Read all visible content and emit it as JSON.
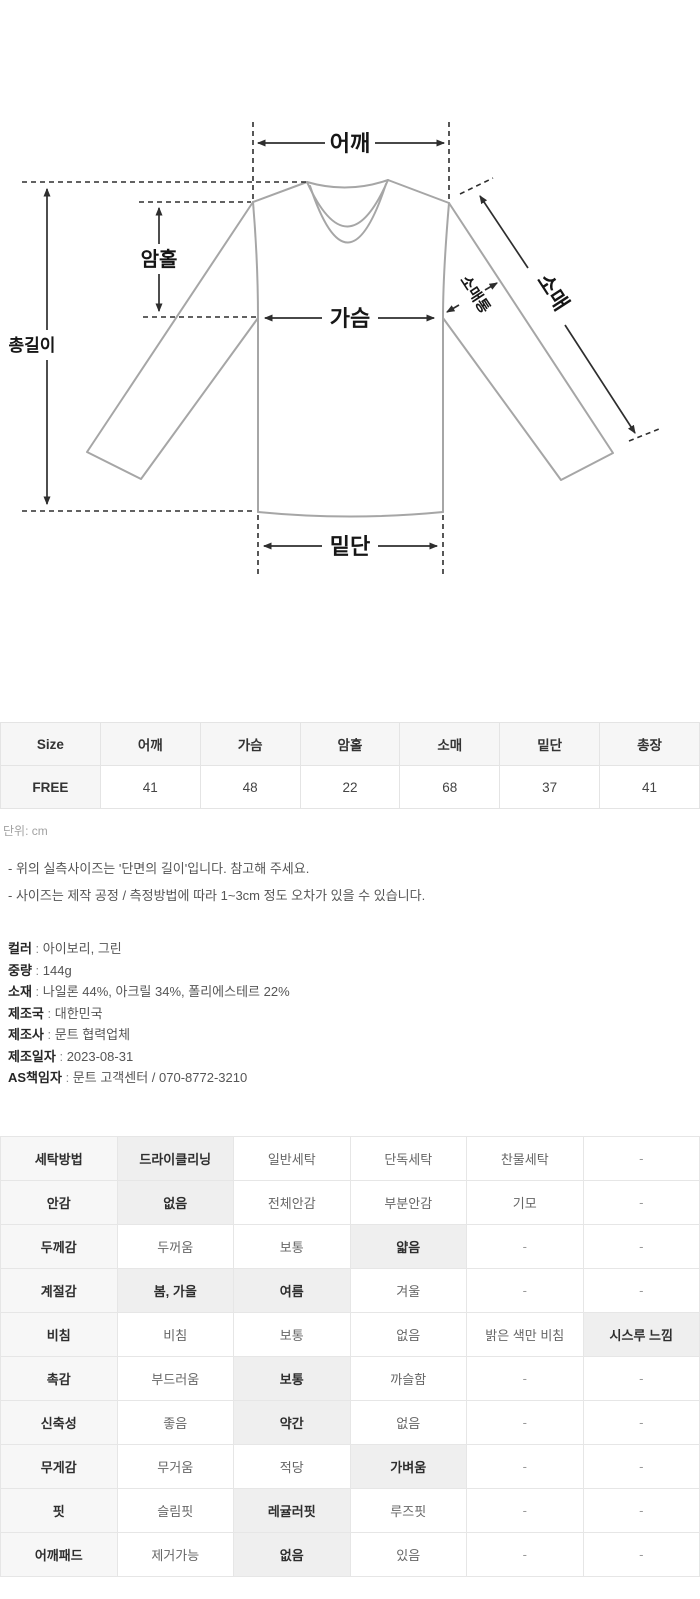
{
  "diagram": {
    "labels": {
      "shoulder": "어깨",
      "armhole": "암홀",
      "chest": "가슴",
      "sleeve_width": "소매통",
      "sleeve": "소매",
      "total_length": "총길이",
      "hem": "밑단"
    }
  },
  "size_table": {
    "headers": [
      "Size",
      "어깨",
      "가슴",
      "암홀",
      "소매",
      "밑단",
      "총장"
    ],
    "rows": [
      {
        "size": "FREE",
        "values": [
          "41",
          "48",
          "22",
          "68",
          "37",
          "41"
        ]
      }
    ],
    "unit_note": "단위: cm"
  },
  "notes": [
    "- 위의 실측사이즈는 '단면의 길이'입니다. 참고해 주세요.",
    "- 사이즈는 제작 공정 / 측정방법에 따라 1~3cm 정도 오차가 있을 수 있습니다."
  ],
  "product_info": [
    {
      "label": "컬러",
      "value": "아이보리, 그린"
    },
    {
      "label": "중량",
      "value": "144g"
    },
    {
      "label": "소재",
      "value": "나일론 44%, 아크릴 34%, 폴리에스테르 22%"
    },
    {
      "label": "제조국",
      "value": "대한민국"
    },
    {
      "label": "제조사",
      "value": "문트 협력업체"
    },
    {
      "label": "제조일자",
      "value": "2023-08-31"
    },
    {
      "label": "AS책임자",
      "value": "문트 고객센터 / 070-8772-3210"
    }
  ],
  "care_table": {
    "rows": [
      {
        "label": "세탁방법",
        "options": [
          {
            "text": "드라이클리닝",
            "selected": true
          },
          {
            "text": "일반세탁",
            "selected": false
          },
          {
            "text": "단독세탁",
            "selected": false
          },
          {
            "text": "찬물세탁",
            "selected": false
          },
          {
            "text": "-",
            "selected": false
          }
        ]
      },
      {
        "label": "안감",
        "options": [
          {
            "text": "없음",
            "selected": true
          },
          {
            "text": "전체안감",
            "selected": false
          },
          {
            "text": "부분안감",
            "selected": false
          },
          {
            "text": "기모",
            "selected": false
          },
          {
            "text": "-",
            "selected": false
          }
        ]
      },
      {
        "label": "두께감",
        "options": [
          {
            "text": "두꺼움",
            "selected": false
          },
          {
            "text": "보통",
            "selected": false
          },
          {
            "text": "얇음",
            "selected": true
          },
          {
            "text": "-",
            "selected": false
          },
          {
            "text": "-",
            "selected": false
          }
        ]
      },
      {
        "label": "계절감",
        "options": [
          {
            "text": "봄, 가을",
            "selected": true
          },
          {
            "text": "여름",
            "selected": true
          },
          {
            "text": "겨울",
            "selected": false
          },
          {
            "text": "-",
            "selected": false
          },
          {
            "text": "-",
            "selected": false
          }
        ]
      },
      {
        "label": "비침",
        "options": [
          {
            "text": "비침",
            "selected": false
          },
          {
            "text": "보통",
            "selected": false
          },
          {
            "text": "없음",
            "selected": false
          },
          {
            "text": "밝은 색만 비침",
            "selected": false
          },
          {
            "text": "시스루 느낌",
            "selected": true
          }
        ]
      },
      {
        "label": "촉감",
        "options": [
          {
            "text": "부드러움",
            "selected": false
          },
          {
            "text": "보통",
            "selected": true
          },
          {
            "text": "까슬함",
            "selected": false
          },
          {
            "text": "-",
            "selected": false
          },
          {
            "text": "-",
            "selected": false
          }
        ]
      },
      {
        "label": "신축성",
        "options": [
          {
            "text": "좋음",
            "selected": false
          },
          {
            "text": "약간",
            "selected": true
          },
          {
            "text": "없음",
            "selected": false
          },
          {
            "text": "-",
            "selected": false
          },
          {
            "text": "-",
            "selected": false
          }
        ]
      },
      {
        "label": "무게감",
        "options": [
          {
            "text": "무거움",
            "selected": false
          },
          {
            "text": "적당",
            "selected": false
          },
          {
            "text": "가벼움",
            "selected": true
          },
          {
            "text": "-",
            "selected": false
          },
          {
            "text": "-",
            "selected": false
          }
        ]
      },
      {
        "label": "핏",
        "options": [
          {
            "text": "슬림핏",
            "selected": false
          },
          {
            "text": "레귤러핏",
            "selected": true
          },
          {
            "text": "루즈핏",
            "selected": false
          },
          {
            "text": "-",
            "selected": false
          },
          {
            "text": "-",
            "selected": false
          }
        ]
      },
      {
        "label": "어깨패드",
        "options": [
          {
            "text": "제거가능",
            "selected": false
          },
          {
            "text": "없음",
            "selected": true
          },
          {
            "text": "있음",
            "selected": false
          },
          {
            "text": "-",
            "selected": false
          },
          {
            "text": "-",
            "selected": false
          }
        ]
      }
    ]
  },
  "colors": {
    "table_header_bg": "#f6f6f6",
    "selected_cell_bg": "#efefef",
    "border": "#e5e5e5",
    "garment_outline": "#a6a6a6",
    "measure_line": "#2e2e2e"
  }
}
